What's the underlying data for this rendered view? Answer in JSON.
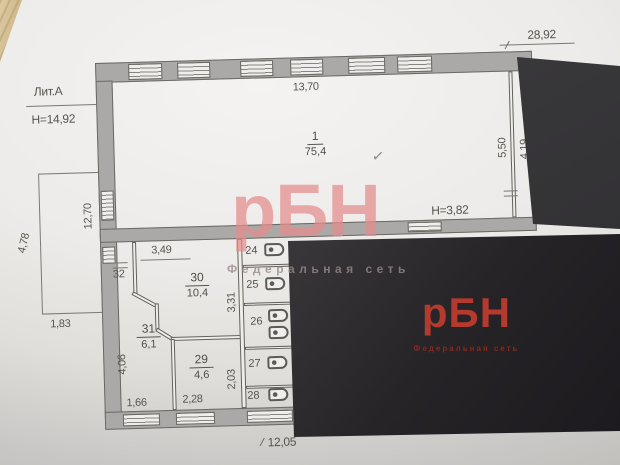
{
  "photo": {
    "watermark": {
      "logo": "рБН",
      "tagline": "Федеральная сеть"
    },
    "business_card": {
      "logo": "рБН",
      "tagline": "Федеральная сеть"
    }
  },
  "plan": {
    "litera": "Лит.А",
    "building_height": "Н=14,92",
    "room_height_note": "Н=3,82",
    "check_mark": "✓",
    "rooms": {
      "hall": {
        "num": "1",
        "area": "75,4"
      },
      "r30": {
        "num": "30",
        "area": "10,4"
      },
      "r31": {
        "num": "31",
        "area": "6,1"
      },
      "r29": {
        "num": "29",
        "area": "4,6"
      },
      "r32": {
        "num": "32"
      },
      "stalls": [
        {
          "num": "24"
        },
        {
          "num": "25"
        },
        {
          "num": "26"
        },
        {
          "num": "27"
        },
        {
          "num": "28"
        }
      ]
    },
    "dims": {
      "total_width": "28,92",
      "hall_width": "13,70",
      "right_depth": "5,50",
      "right_depth_inner": "4,19",
      "annex_depth": "4,78",
      "left_inner": "12,70",
      "annex_width": "1,83",
      "corridor_width": "3,49",
      "stall_column": "3,31",
      "room29_depth": "2,03",
      "room31_depth": "4,06",
      "room31_width": "1,66",
      "room29_width": "2,28",
      "bottom_width": "12,05"
    },
    "colors": {
      "wall_fill": "#aba9a7",
      "line": "#66645f",
      "card_red": "#b43a2d",
      "watermark_pink": "#e48c8c"
    }
  }
}
